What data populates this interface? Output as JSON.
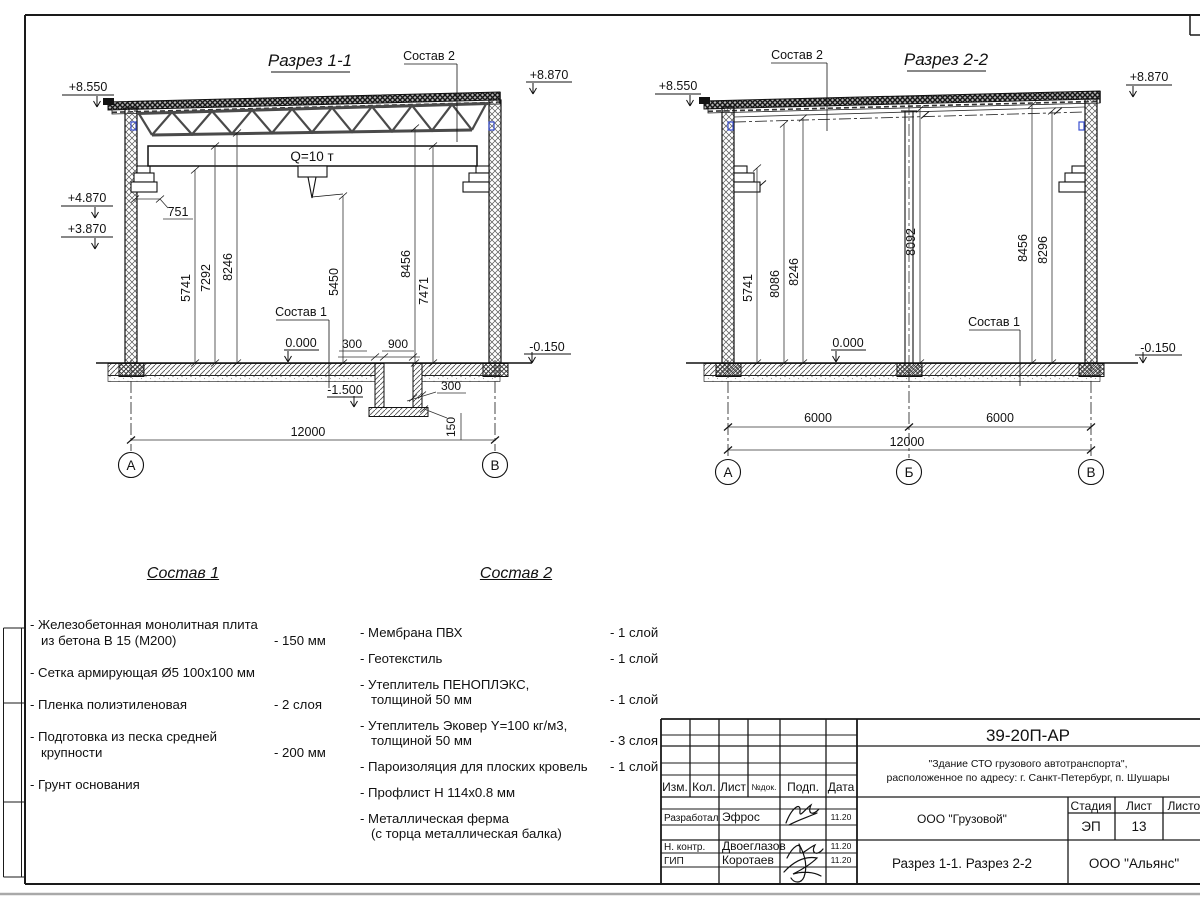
{
  "sections": {
    "s1": {
      "title": "Разрез 1-1",
      "crane_label": "Q=10 т",
      "leader_roof": "Состав 2",
      "leader_floor": "Состав 1",
      "elev": {
        "top_left": "+8.550",
        "top_right": "+8.870",
        "corbel_top": "+4.870",
        "corbel_bot": "+3.870",
        "zero": "0.000",
        "floor_out": "-0.150",
        "pit": "-1.500"
      },
      "dims": {
        "corbel": "751",
        "v1": "5741",
        "v2": "7292",
        "v3": "8246",
        "v4": "5450",
        "v5": "8456",
        "v6": "7471",
        "floor300": "300",
        "pit_width": "900",
        "pit300": "300",
        "pit_slab": "150",
        "total": "12000"
      },
      "axes": {
        "left": "А",
        "right": "В"
      }
    },
    "s2": {
      "title": "Разрез 2-2",
      "leader_roof": "Состав 2",
      "leader_floor": "Состав 1",
      "elev": {
        "top_left": "+8.550",
        "top_right": "+8.870",
        "zero": "0.000",
        "floor_out": "-0.150"
      },
      "dims": {
        "v1": "5741",
        "v2": "8086",
        "v3": "8246",
        "v4": "8092",
        "v5": "8456",
        "v6": "8296",
        "span1": "6000",
        "span2": "6000",
        "total": "12000"
      },
      "axes": {
        "left": "А",
        "mid": "Б",
        "right": "В"
      }
    }
  },
  "legend1": {
    "title": "Состав 1",
    "items": [
      {
        "line1": "- Железобетонная  монолитная плита",
        "line2": "из бетона В 15 (М200)",
        "value": "- 150 мм"
      },
      {
        "line1": "- Сетка армирующая Ø5 100х100 мм",
        "line2": "",
        "value": ""
      },
      {
        "line1": "- Пленка полиэтиленовая",
        "line2": "",
        "value": "- 2 слоя"
      },
      {
        "line1": "- Подготовка из песка средней",
        "line2": "крупности",
        "value": "- 200 мм"
      },
      {
        "line1": "- Грунт основания",
        "line2": "",
        "value": ""
      }
    ]
  },
  "legend2": {
    "title": "Состав 2",
    "items": [
      {
        "line1": "- Мембрана ПВХ",
        "line2": "",
        "value": "- 1 слой"
      },
      {
        "line1": "- Геотекстиль",
        "line2": "",
        "value": "- 1 слой"
      },
      {
        "line1": "- Утеплитель ПЕНОПЛЭКС,",
        "line2": "толщиной 50 мм",
        "value": "- 1 слой"
      },
      {
        "line1": "- Утеплитель Эковер Y=100 кг/м3,",
        "line2": "толщиной 50 мм",
        "value": "- 3 слоя"
      },
      {
        "line1": "- Пароизоляция для плоских кровель",
        "line2": "",
        "value": "- 1 слой"
      },
      {
        "line1": "- Профлист Н 114х0.8 мм",
        "line2": "",
        "value": ""
      },
      {
        "line1": "- Металлическая ферма",
        "line2": "(с торца металлическая балка)",
        "value": ""
      }
    ]
  },
  "titleblock": {
    "code": "39-20П-АР",
    "object_line1": "\"Здание СТО грузового автотранспорта\",",
    "object_line2": "расположенное по адресу: г. Санкт-Петербург, п. Шушары",
    "col_izm": "Изм.",
    "col_kol": "Кол.",
    "col_list": "Лист",
    "col_ndok": "№док.",
    "col_podp": "Подп.",
    "col_data": "Дата",
    "row1_role": "Разработал",
    "row1_name": "Эфрос",
    "row1_date": "11.20",
    "row2_role": "Н. контр.",
    "row2_name": "Двоеглазов",
    "row2_date": "11.20",
    "row3_role": "ГИП",
    "row3_name": "Коротаев",
    "row3_date": "11.20",
    "company": "ООО \"Грузовой\"",
    "stage_label": "Стадия",
    "sheet_label": "Лист",
    "sheets_label": "Листов",
    "stage": "ЭП",
    "sheet_no": "13",
    "doc_title": "Разрез 1-1. Разрез 2-2",
    "company2": "ООО \"Альянс\""
  },
  "colors": {
    "line": "#1a1a1a",
    "steel": "#4a4a4a",
    "accent_blue": "#3a4fd0",
    "paper": "#ffffff"
  }
}
